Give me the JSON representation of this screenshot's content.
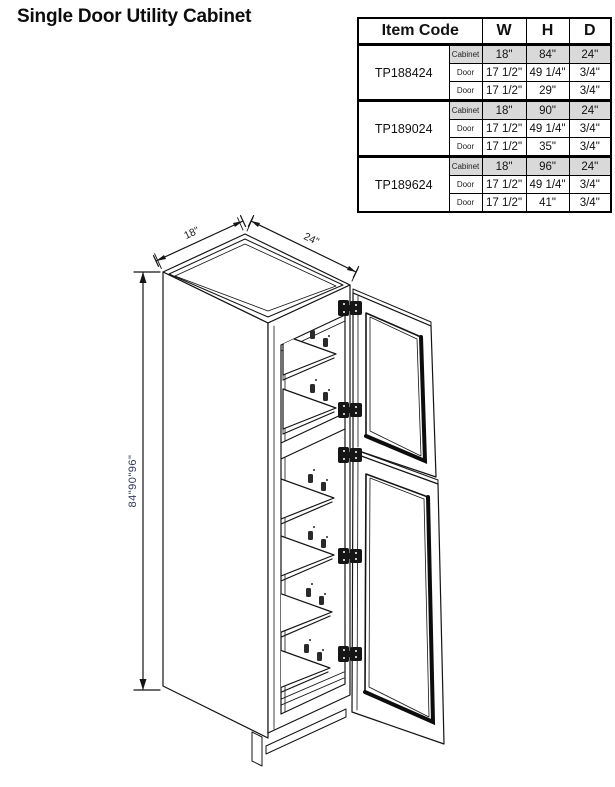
{
  "page": {
    "title": "Single Door Utility Cabinet"
  },
  "table": {
    "header": {
      "item_code": "Item Code",
      "w": "W",
      "h": "H",
      "d": "D"
    },
    "groups": [
      {
        "code": "TP188424",
        "rows": [
          {
            "part": "Cabinet",
            "w": "18\"",
            "h": "84\"",
            "d": "24\""
          },
          {
            "part": "Door",
            "w": "17 1/2\"",
            "h": "49 1/4\"",
            "d": "3/4\""
          },
          {
            "part": "Door",
            "w": "17 1/2\"",
            "h": "29\"",
            "d": "3/4\""
          }
        ]
      },
      {
        "code": "TP189024",
        "rows": [
          {
            "part": "Cabinet",
            "w": "18\"",
            "h": "90\"",
            "d": "24\""
          },
          {
            "part": "Door",
            "w": "17 1/2\"",
            "h": "49 1/4\"",
            "d": "3/4\""
          },
          {
            "part": "Door",
            "w": "17 1/2\"",
            "h": "35\"",
            "d": "3/4\""
          }
        ]
      },
      {
        "code": "TP189624",
        "rows": [
          {
            "part": "Cabinet",
            "w": "18\"",
            "h": "96\"",
            "d": "24\""
          },
          {
            "part": "Door",
            "w": "17 1/2\"",
            "h": "49 1/4\"",
            "d": "3/4\""
          },
          {
            "part": "Door",
            "w": "17 1/2\"",
            "h": "41\"",
            "d": "3/4\""
          }
        ]
      }
    ]
  },
  "drawing": {
    "top_left_dim": "18\"",
    "top_right_dim": "24\"",
    "side_dim": "84\"90\"96\"",
    "colors": {
      "ink": "#141414",
      "side_dim_label": "#333a63",
      "cabinet_row_shade": "#d9d9d9"
    }
  }
}
